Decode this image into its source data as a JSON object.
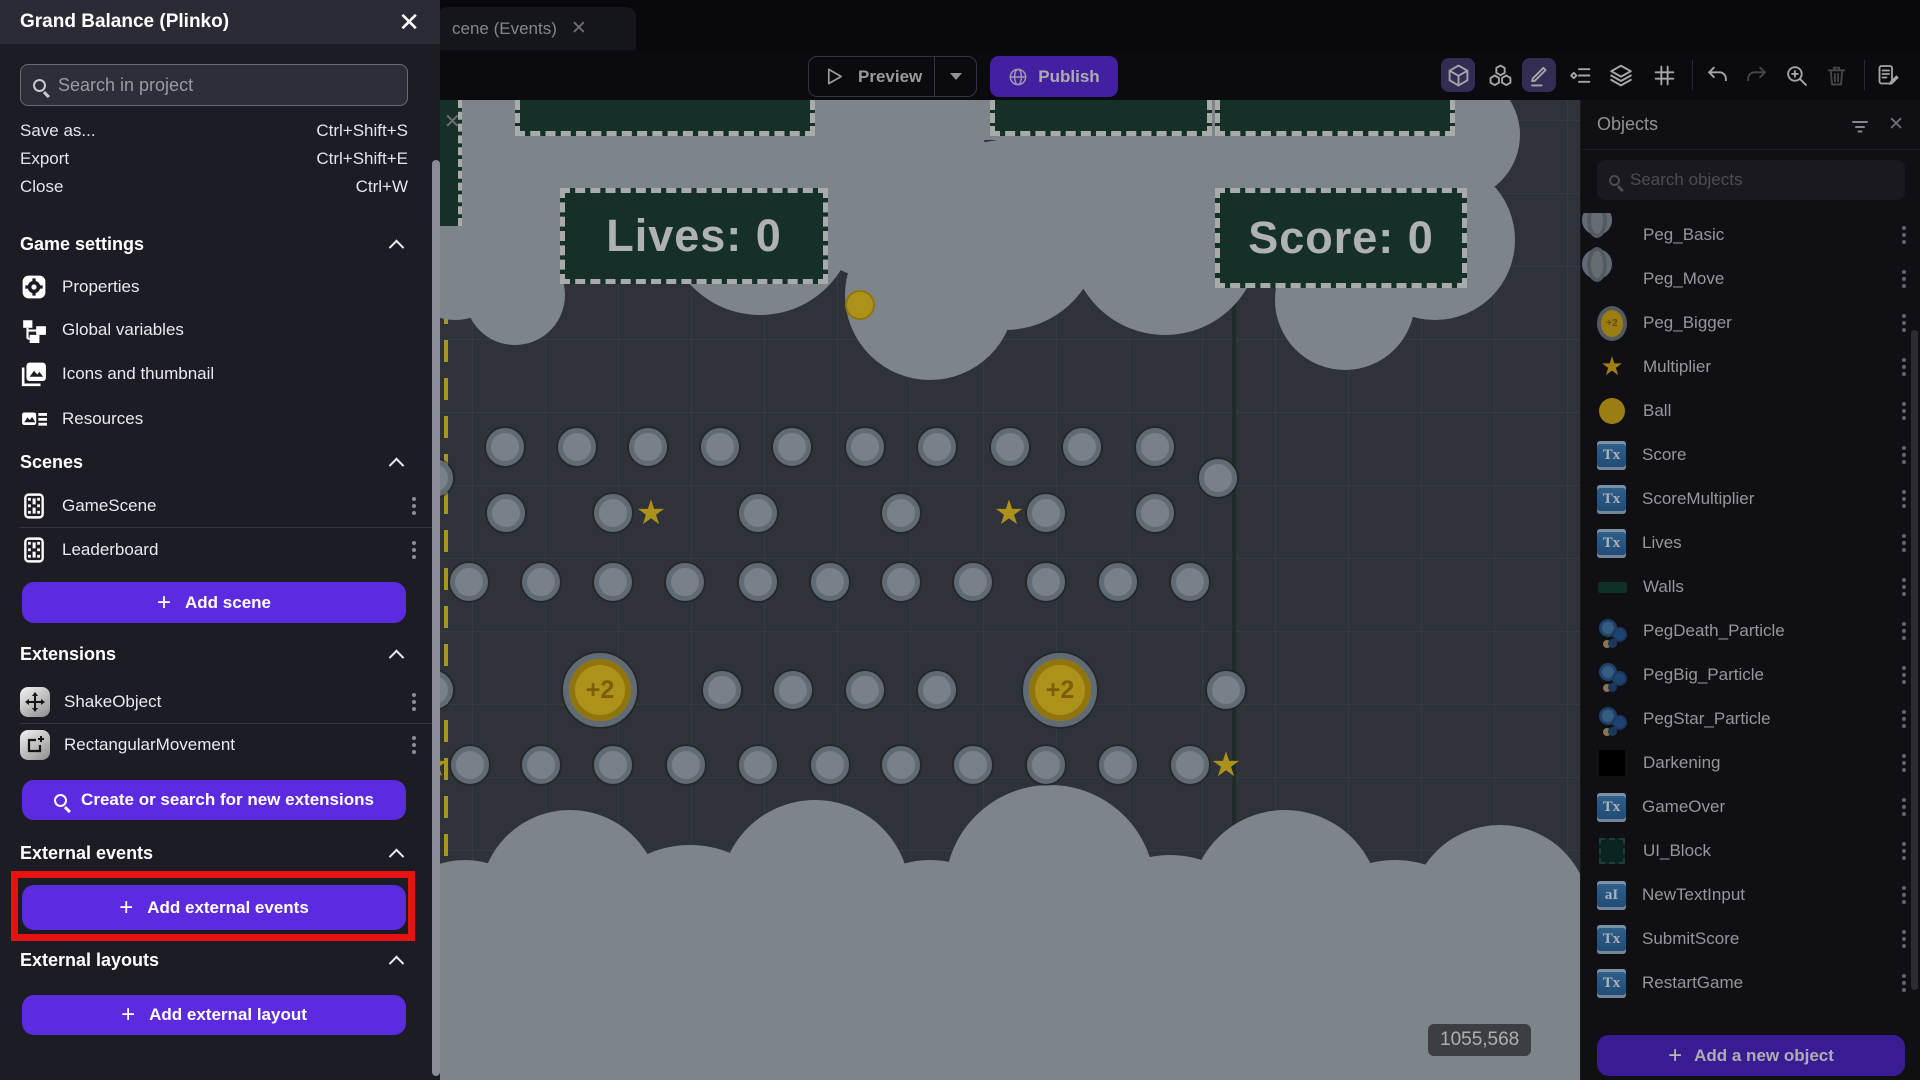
{
  "colors": {
    "accent": "#5d2bdf",
    "highlight_red": "#e81212",
    "coin_yellow": "#f2ca25",
    "panel_teal": "#1c4339",
    "canvas_bg": "#42464e",
    "cloud": "#aeb8c0"
  },
  "drawer": {
    "title": "Grand Balance (Plinko)",
    "search_placeholder": "Search in project",
    "menu": [
      {
        "label": "Save as...",
        "shortcut": "Ctrl+Shift+S"
      },
      {
        "label": "Export",
        "shortcut": "Ctrl+Shift+E"
      },
      {
        "label": "Close",
        "shortcut": "Ctrl+W"
      }
    ],
    "game_settings": {
      "label": "Game settings",
      "items": [
        "Properties",
        "Global variables",
        "Icons and thumbnail",
        "Resources"
      ]
    },
    "scenes": {
      "label": "Scenes",
      "items": [
        "GameScene",
        "Leaderboard"
      ],
      "add_button": "Add scene"
    },
    "extensions": {
      "label": "Extensions",
      "items": [
        "ShakeObject",
        "RectangularMovement"
      ],
      "search_button": "Create or search for new extensions"
    },
    "external_events": {
      "label": "External events",
      "add_button": "Add external events"
    },
    "external_layouts": {
      "label": "External layouts",
      "add_button": "Add external layout"
    }
  },
  "tabbar": {
    "active_tab": "cene (Events)"
  },
  "toolbar": {
    "preview": "Preview",
    "publish": "Publish"
  },
  "scene": {
    "hud_lives": "Lives: 0",
    "hud_score": "Score: 0",
    "multiplier_text": "25%",
    "coin_label": "+2",
    "cursor_coords": "1055,568",
    "peg_rows": [
      {
        "y": 347,
        "xs": [
          65,
          137,
          208,
          280,
          352,
          425,
          497,
          570,
          642,
          715
        ]
      },
      {
        "y": 378,
        "xs": [
          -6,
          778
        ]
      },
      {
        "y": 413,
        "xs": [
          66,
          173,
          318,
          461,
          606,
          715
        ]
      },
      {
        "y": 482,
        "xs": [
          29,
          101,
          173,
          245,
          318,
          390,
          461,
          533,
          606,
          678,
          750
        ]
      },
      {
        "y": 590,
        "xs": [
          -6,
          282,
          353,
          425,
          497,
          786
        ]
      },
      {
        "y": 665,
        "xs": [
          30,
          101,
          173,
          246,
          318,
          390,
          461,
          533,
          606,
          678,
          750
        ]
      }
    ],
    "stars": [
      [
        211,
        413
      ],
      [
        569,
        413
      ],
      [
        -6,
        665
      ],
      [
        786,
        665
      ]
    ],
    "coins": [
      [
        160,
        590
      ],
      [
        620,
        590
      ]
    ],
    "ball": [
      420,
      205
    ]
  },
  "objects_panel": {
    "title": "Objects",
    "search_placeholder": "Search objects",
    "items": [
      {
        "name": "Peg_Basic",
        "icon": "peg"
      },
      {
        "name": "Peg_Move",
        "icon": "peg"
      },
      {
        "name": "Peg_Bigger",
        "icon": "pegbig"
      },
      {
        "name": "Multiplier",
        "icon": "star"
      },
      {
        "name": "Ball",
        "icon": "ball"
      },
      {
        "name": "Score",
        "icon": "text"
      },
      {
        "name": "ScoreMultiplier",
        "icon": "text"
      },
      {
        "name": "Lives",
        "icon": "text"
      },
      {
        "name": "Walls",
        "icon": "walls"
      },
      {
        "name": "PegDeath_Particle",
        "icon": "particle"
      },
      {
        "name": "PegBig_Particle",
        "icon": "particle"
      },
      {
        "name": "PegStar_Particle",
        "icon": "particle"
      },
      {
        "name": "Darkening",
        "icon": "black"
      },
      {
        "name": "GameOver",
        "icon": "text"
      },
      {
        "name": "UI_Block",
        "icon": "uiblock"
      },
      {
        "name": "NewTextInput",
        "icon": "textinput"
      },
      {
        "name": "SubmitScore",
        "icon": "text"
      },
      {
        "name": "RestartGame",
        "icon": "text"
      }
    ],
    "add_button": "Add a new object"
  }
}
